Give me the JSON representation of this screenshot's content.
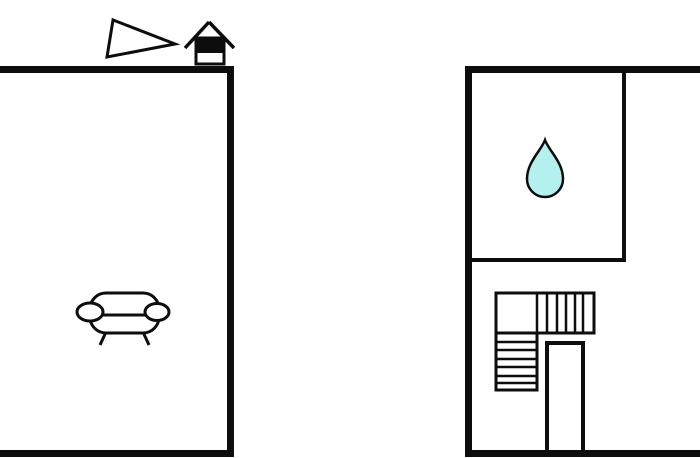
{
  "scene": {
    "kind": "floor-plan",
    "rooms": [
      {
        "id": "left-room",
        "furniture": [
          "sofa"
        ],
        "exterior_markers": [
          "direction-triangle",
          "house-marker"
        ]
      },
      {
        "id": "right-room",
        "inner_rooms": [
          "bathroom"
        ],
        "features": [
          "l-shaped-staircase",
          "door-opening"
        ]
      }
    ],
    "symbols": [
      "sofa-icon",
      "water-drop-icon",
      "house-icon",
      "triangle-icon",
      "stairs-icon"
    ]
  },
  "colors": {
    "wall": "#0d0d0d",
    "background": "#ffffff",
    "water_drop_fill": "#b4f0ee",
    "symbol_stroke": "#0d0d0d"
  },
  "floorplan": {
    "width": 700,
    "height": 458,
    "elements": [
      {
        "type": "polygon",
        "name": "direction-triangle-icon",
        "points": "113,20 107,57 175,44",
        "fill": "#ffffff",
        "stroke": "#0d0d0d",
        "sw": 3
      },
      {
        "type": "line",
        "name": "house-icon-roof-left",
        "x1": 209,
        "y1": 22,
        "x2": 185,
        "y2": 48,
        "stroke": "#0d0d0d",
        "sw": 3.5
      },
      {
        "type": "line",
        "name": "house-icon-roof-right",
        "x1": 209,
        "y1": 22,
        "x2": 234,
        "y2": 48,
        "stroke": "#0d0d0d",
        "sw": 3.5
      },
      {
        "type": "rect",
        "name": "house-icon-body",
        "x": 196,
        "y": 38,
        "w": 28,
        "h": 26,
        "fill": "#ffffff",
        "stroke": "#0d0d0d",
        "sw": 3
      },
      {
        "type": "rect",
        "name": "house-icon-band",
        "x": 195,
        "y": 37,
        "w": 30,
        "h": 16,
        "fill": "#0d0d0d"
      },
      {
        "type": "rect",
        "name": "sofa-icon-body",
        "x": 90,
        "y": 293,
        "w": 69,
        "h": 40,
        "rx": 16,
        "fill": "#ffffff",
        "stroke": "#0d0d0d",
        "sw": 3
      },
      {
        "type": "line",
        "name": "sofa-icon-seat-line",
        "x1": 102,
        "y1": 315,
        "x2": 148,
        "y2": 315,
        "stroke": "#0d0d0d",
        "sw": 3
      },
      {
        "type": "ellipse",
        "name": "sofa-icon-armrest-left",
        "cx": 90,
        "cy": 312,
        "rx": 13,
        "ry": 9,
        "fill": "#ffffff",
        "stroke": "#0d0d0d",
        "sw": 3
      },
      {
        "type": "ellipse",
        "name": "sofa-icon-armrest-right",
        "cx": 157,
        "cy": 312,
        "rx": 12,
        "ry": 8.5,
        "fill": "#ffffff",
        "stroke": "#0d0d0d",
        "sw": 3
      },
      {
        "type": "line",
        "name": "sofa-icon-leg-left",
        "x1": 106,
        "y1": 332,
        "x2": 100,
        "y2": 345,
        "stroke": "#0d0d0d",
        "sw": 3
      },
      {
        "type": "line",
        "name": "sofa-icon-leg-right",
        "x1": 143,
        "y1": 332,
        "x2": 149,
        "y2": 345,
        "stroke": "#0d0d0d",
        "sw": 3
      },
      {
        "type": "path",
        "name": "water-drop-icon",
        "d": "M545 140 C549 151 563 162 563 179 A18 18 0 1 1 527 179 C527 162 541 151 545 140 Z",
        "fill": "#b4f0ee",
        "stroke": "#0d0d0d",
        "sw": 2.5
      },
      {
        "type": "rect",
        "name": "stairs-upper-run",
        "x": 496,
        "y": 293,
        "w": 98,
        "h": 40,
        "fill": "#ffffff",
        "stroke": "#0d0d0d",
        "sw": 3
      },
      {
        "type": "line",
        "name": "stairs-tread",
        "x1": 537,
        "y1": 293,
        "x2": 537,
        "y2": 333,
        "stroke": "#0d0d0d",
        "sw": 2.5
      },
      {
        "type": "line",
        "name": "stairs-tread",
        "x1": 547,
        "y1": 293,
        "x2": 547,
        "y2": 333,
        "stroke": "#0d0d0d",
        "sw": 2.5
      },
      {
        "type": "line",
        "name": "stairs-tread",
        "x1": 557,
        "y1": 293,
        "x2": 557,
        "y2": 333,
        "stroke": "#0d0d0d",
        "sw": 2.5
      },
      {
        "type": "line",
        "name": "stairs-tread",
        "x1": 566,
        "y1": 293,
        "x2": 566,
        "y2": 333,
        "stroke": "#0d0d0d",
        "sw": 2.5
      },
      {
        "type": "line",
        "name": "stairs-tread",
        "x1": 575,
        "y1": 293,
        "x2": 575,
        "y2": 333,
        "stroke": "#0d0d0d",
        "sw": 2.5
      },
      {
        "type": "line",
        "name": "stairs-tread",
        "x1": 583,
        "y1": 293,
        "x2": 583,
        "y2": 333,
        "stroke": "#0d0d0d",
        "sw": 2.5
      },
      {
        "type": "rect",
        "name": "stairs-lower-run",
        "x": 496,
        "y": 333,
        "w": 41,
        "h": 57,
        "fill": "#ffffff",
        "stroke": "#0d0d0d",
        "sw": 3
      },
      {
        "type": "line",
        "name": "stairs-tread",
        "x1": 496,
        "y1": 342,
        "x2": 537,
        "y2": 342,
        "stroke": "#0d0d0d",
        "sw": 2.5
      },
      {
        "type": "line",
        "name": "stairs-tread",
        "x1": 496,
        "y1": 350,
        "x2": 537,
        "y2": 350,
        "stroke": "#0d0d0d",
        "sw": 2.5
      },
      {
        "type": "line",
        "name": "stairs-tread",
        "x1": 496,
        "y1": 359,
        "x2": 537,
        "y2": 359,
        "stroke": "#0d0d0d",
        "sw": 2.5
      },
      {
        "type": "line",
        "name": "stairs-tread",
        "x1": 496,
        "y1": 367,
        "x2": 537,
        "y2": 367,
        "stroke": "#0d0d0d",
        "sw": 2.5
      },
      {
        "type": "line",
        "name": "stairs-tread",
        "x1": 496,
        "y1": 376,
        "x2": 537,
        "y2": 376,
        "stroke": "#0d0d0d",
        "sw": 2.5
      },
      {
        "type": "line",
        "name": "stairs-tread",
        "x1": 496,
        "y1": 383,
        "x2": 537,
        "y2": 383,
        "stroke": "#0d0d0d",
        "sw": 2.5
      },
      {
        "type": "line",
        "name": "door-opening-left",
        "x1": 547,
        "y1": 341,
        "x2": 547,
        "y2": 455,
        "stroke": "#0d0d0d",
        "sw": 4
      },
      {
        "type": "line",
        "name": "door-opening-right",
        "x1": 583,
        "y1": 341,
        "x2": 583,
        "y2": 455,
        "stroke": "#0d0d0d",
        "sw": 4
      },
      {
        "type": "line",
        "name": "door-opening-top",
        "x1": 545,
        "y1": 343,
        "x2": 585,
        "y2": 343,
        "stroke": "#0d0d0d",
        "sw": 4
      },
      {
        "type": "rect",
        "name": "bathroom-right-wall",
        "x": 622,
        "y": 70,
        "w": 4,
        "h": 192,
        "fill": "#0d0d0d"
      },
      {
        "type": "rect",
        "name": "bathroom-bottom-wall",
        "x": 469,
        "y": 258,
        "w": 157,
        "h": 4,
        "fill": "#0d0d0d"
      },
      {
        "type": "rect",
        "name": "left-room-top-wall",
        "x": 0,
        "y": 66,
        "w": 234,
        "h": 7,
        "fill": "#0d0d0d"
      },
      {
        "type": "rect",
        "name": "left-room-right-wall",
        "x": 227,
        "y": 66,
        "w": 7,
        "h": 391,
        "fill": "#0d0d0d"
      },
      {
        "type": "rect",
        "name": "left-room-bottom-wall",
        "x": 0,
        "y": 450,
        "w": 234,
        "h": 7,
        "fill": "#0d0d0d"
      },
      {
        "type": "rect",
        "name": "right-room-left-wall",
        "x": 465,
        "y": 66,
        "w": 7,
        "h": 391,
        "fill": "#0d0d0d"
      },
      {
        "type": "rect",
        "name": "right-room-top-wall",
        "x": 465,
        "y": 66,
        "w": 235,
        "h": 7,
        "fill": "#0d0d0d"
      },
      {
        "type": "rect",
        "name": "right-room-bottom-wall",
        "x": 465,
        "y": 450,
        "w": 235,
        "h": 7,
        "fill": "#0d0d0d"
      }
    ]
  }
}
